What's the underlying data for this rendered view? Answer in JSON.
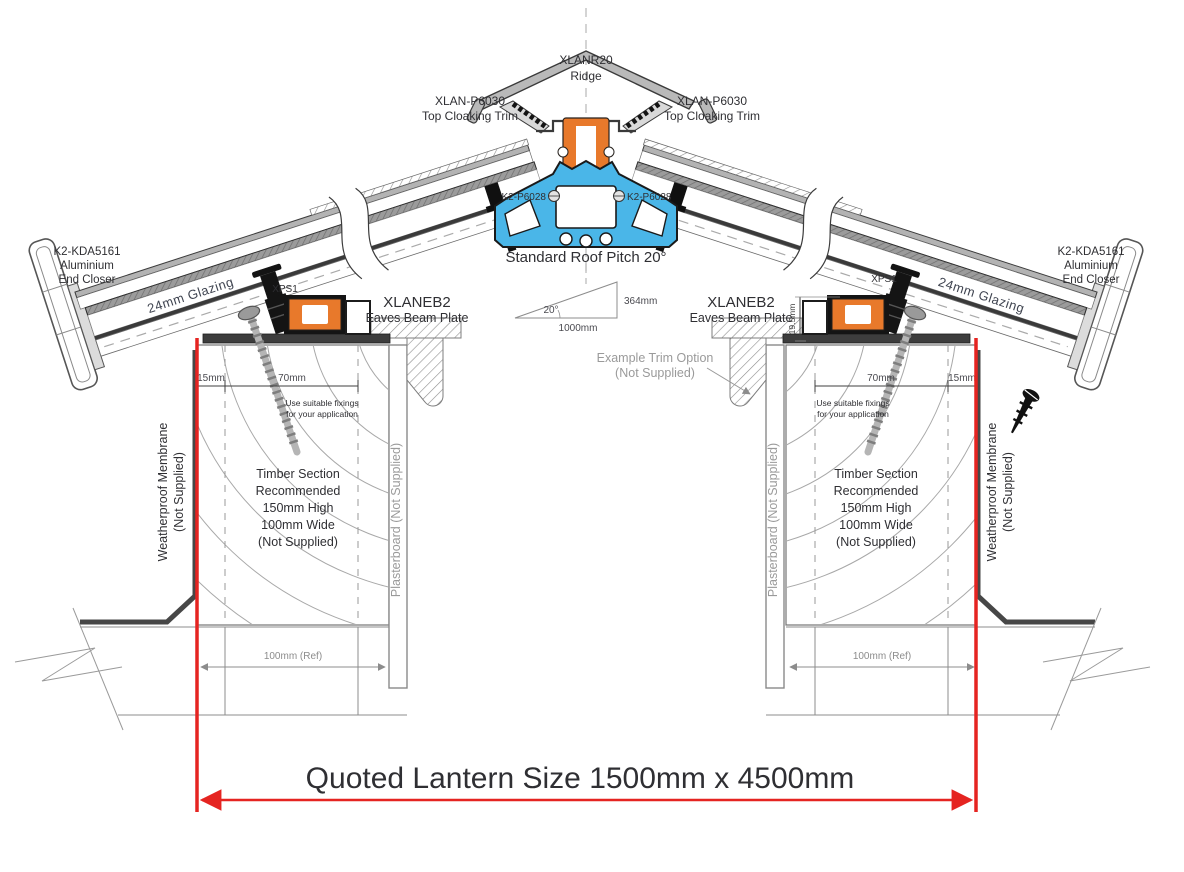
{
  "drawing": {
    "ridge": {
      "part": "XLANR20",
      "name": "Ridge"
    },
    "top_cloaking_trim": {
      "part": "XLAN-P6030",
      "name": "Top Cloaking Trim"
    },
    "ridge_fixing": {
      "part": "K2-P6028"
    },
    "roof_pitch": {
      "caption": "Standard Roof Pitch 20°",
      "angle": "20°",
      "run": "1000mm",
      "rise": "364mm"
    },
    "end_closer": {
      "part": "K2-KDA5161",
      "material": "Aluminium",
      "name": "End Closer"
    },
    "glazing": {
      "label": "24mm Glazing"
    },
    "thermal_spacer": {
      "part": "XPS1"
    },
    "eaves_beam": {
      "part": "XLANEB2",
      "name": "Eaves Beam Plate",
      "upstand_height": "19.5mm"
    },
    "dimensions": {
      "edge": "15mm",
      "fixing_zone": "70mm",
      "wall_ref": "100mm (Ref)"
    },
    "fixing_note": {
      "line1": "Use suitable fixings",
      "line2": "for your application"
    },
    "timber_note": {
      "line1": "Timber Section",
      "line2": "Recommended",
      "line3": "150mm High",
      "line4": "100mm Wide",
      "line5": "(Not Supplied)"
    },
    "membrane": {
      "line1": "Weatherproof Membrane",
      "line2": "(Not Supplied)"
    },
    "plasterboard": {
      "label": "Plasterboard (Not Supplied)"
    },
    "trim_option": {
      "line1": "Example  Trim Option",
      "line2": "(Not Supplied)"
    },
    "quoted_size": {
      "label": "Quoted Lantern Size 1500mm x 4500mm"
    },
    "colors": {
      "accent_red": "#e52421",
      "thermal_orange": "#e8792b",
      "ridge_blue": "#4ab6e8"
    }
  }
}
